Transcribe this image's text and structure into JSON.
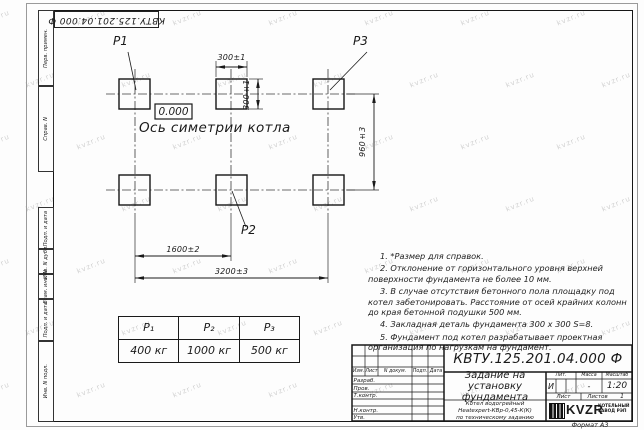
{
  "watermark": {
    "text": "kvzr.ru"
  },
  "frame": {
    "top_designation": "КВТУ.125.201.04.000 Ф",
    "side_labels": [
      "Перв. примен.",
      "Справ. N",
      "Подп. и дата",
      "Инв. N дубл.",
      "Взам. инв. N",
      "Подп. и дата",
      "Инв. N подл."
    ],
    "format_label": "Формат А3"
  },
  "drawing": {
    "pad_labels": {
      "p1": "P1",
      "p2": "P2",
      "p3": "P3"
    },
    "elevation": "0.000",
    "axis_label": "Ось симетрии котла",
    "dimensions": {
      "pad_width_top": "300±1",
      "pad_height_side": "300±1",
      "row_spacing": "960±3",
      "col_spacing": "1600±2",
      "total_span": "3200±3"
    }
  },
  "notes": {
    "items": [
      "1. *Размер для справок.",
      "2. Отклонение от горизонтального уровня верхней поверхности фундамента не более 10 мм.",
      "3. В случае отсутствия бетонного пола площадку под котел забетонировать. Расстояние от осей крайних колонн до края бетонной подушки 500 мм.",
      "4. Закладная деталь фундамента 300 x 300 S=8.",
      "5. Фундамент под котел разрабатывает проектная организация по нагрузкам на фундамент."
    ]
  },
  "load_table": {
    "headers": [
      "P₁",
      "P₂",
      "P₃"
    ],
    "values": [
      "400 кг",
      "1000 кг",
      "500 кг"
    ]
  },
  "title_block": {
    "designation": "КВТУ.125.201.04.000 Ф",
    "doc_title": "Задание на установку фундамента",
    "subtitle_lines": [
      "Котел водогрейный",
      "Heatexpert-КВр-0,45-К(К)",
      "по техническому заданию"
    ],
    "header_cols": [
      "Изм.",
      "Лист",
      "N докум.",
      "Подп.",
      "Дата"
    ],
    "row_labels": [
      "Разраб.",
      "Пров.",
      "Т.контр.",
      "Н.контр.",
      "Утв."
    ],
    "lit_header": "Лит.",
    "mass_header": "Масса",
    "scale_header": "Масштаб",
    "lit_value": "И",
    "mass_value": "-",
    "scale_value": "1:20",
    "sheet_label": "Лист",
    "sheets_label": "Листов",
    "sheets_value": "1",
    "logo_text": "KVZR",
    "logo_caption_lines": [
      "КОТЕЛЬНЫЙ",
      "ЗАВОД РЭП"
    ]
  },
  "colors": {
    "line": "#1a1a1a",
    "watermark": "#d2d2d2"
  }
}
